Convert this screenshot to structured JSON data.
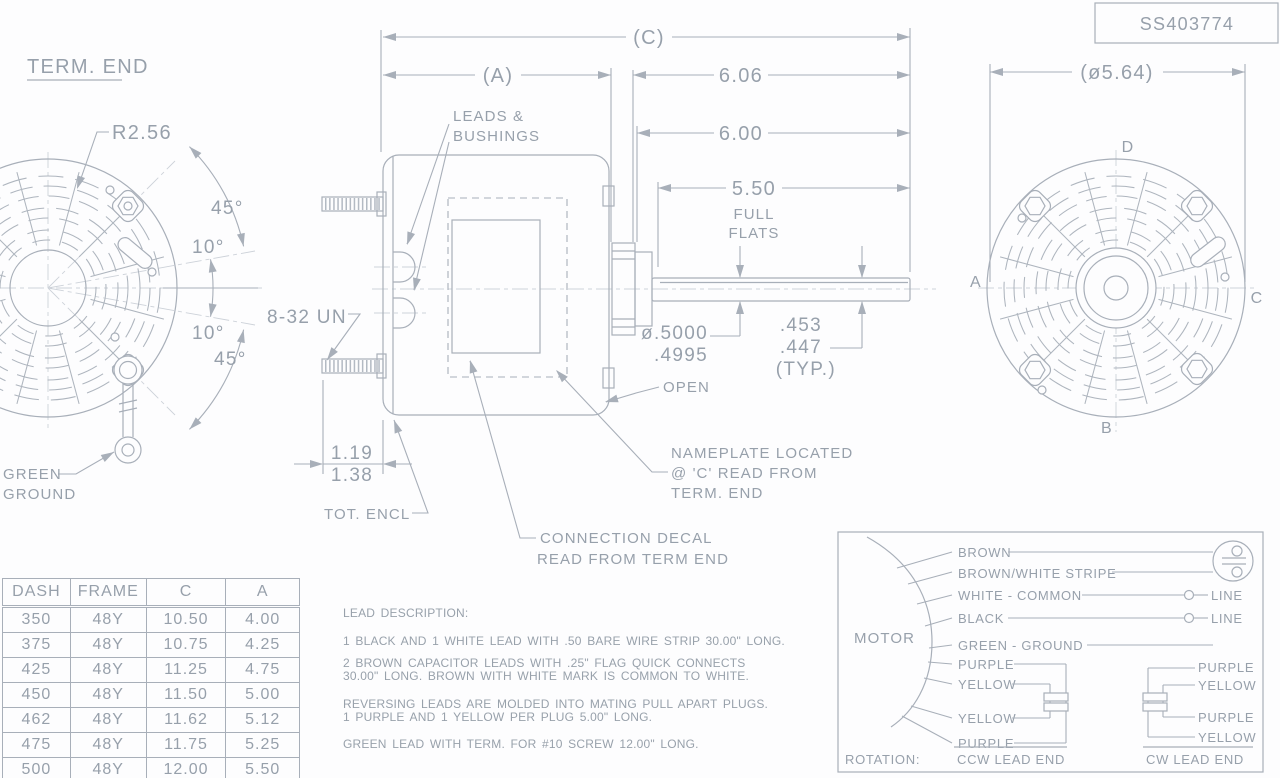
{
  "title_block": {
    "drawing_number": "SS403774"
  },
  "term_end_view": {
    "title": "TERM. END",
    "radius": "R2.56",
    "angle_top_45": "45°",
    "angle_top_10": "10°",
    "angle_bottom_10": "10°",
    "angle_bottom_45": "45°",
    "ground_line1": "GREEN",
    "ground_line2": "GROUND"
  },
  "side_view": {
    "dim_c": "(C)",
    "dim_a": "(A)",
    "dim_6_06": "6.06",
    "dim_6_00": "6.00",
    "dim_5_50": "5.50",
    "full_flats_1": "FULL",
    "full_flats_2": "FLATS",
    "leads_note_1": "LEADS &",
    "leads_note_2": "BUSHINGS",
    "stud_thread": "8-32 UN",
    "stud_dim_1": "1.19",
    "stud_dim_2": "1.38",
    "enclosure_note": "TOT. ENCL",
    "open_note": "OPEN",
    "shaft_dia_1": "ø.5000",
    "shaft_dia_2": ".4995",
    "flat_dim_1": ".453",
    "flat_dim_2": ".447",
    "flat_dim_3": "(TYP.)",
    "nameplate_note_1": "NAMEPLATE LOCATED",
    "nameplate_note_2": "@ 'C' READ FROM",
    "nameplate_note_3": "TERM. END",
    "decal_note_1": "CONNECTION DECAL",
    "decal_note_2": "READ FROM TERM END"
  },
  "shaft_end_view": {
    "dim_dia": "(ø5.64)",
    "marker_a": "A",
    "marker_b": "B",
    "marker_c": "C",
    "marker_d": "D"
  },
  "spec_table": {
    "headers": [
      "DASH",
      "FRAME",
      "C",
      "A"
    ],
    "rows": [
      {
        "dash": "350",
        "frame": "48Y",
        "c": "10.50",
        "a": "4.00"
      },
      {
        "dash": "375",
        "frame": "48Y",
        "c": "10.75",
        "a": "4.25"
      },
      {
        "dash": "425",
        "frame": "48Y",
        "c": "11.25",
        "a": "4.75"
      },
      {
        "dash": "450",
        "frame": "48Y",
        "c": "11.50",
        "a": "5.00"
      },
      {
        "dash": "462",
        "frame": "48Y",
        "c": "11.62",
        "a": "5.12"
      },
      {
        "dash": "475",
        "frame": "48Y",
        "c": "11.75",
        "a": "5.25"
      },
      {
        "dash": "500",
        "frame": "48Y",
        "c": "12.00",
        "a": "5.50"
      }
    ]
  },
  "lead_description": {
    "title": "LEAD DESCRIPTION:",
    "p1_l1": "1 BLACK AND 1 WHITE LEAD WITH .50 BARE WIRE STRIP 30.00\" LONG.",
    "p2_l1": "2 BROWN CAPACITOR LEADS WITH .25\" FLAG QUICK CONNECTS",
    "p2_l2": "30.00\" LONG. BROWN WITH WHITE MARK IS COMMON TO WHITE.",
    "p3_l1": "REVERSING LEADS ARE MOLDED INTO MATING PULL APART PLUGS.",
    "p3_l2": "1 PURPLE AND 1 YELLOW PER PLUG 5.00\" LONG.",
    "p4_l1": "GREEN LEAD WITH TERM. FOR #10 SCREW 12.00\" LONG."
  },
  "wiring_diagram": {
    "motor_label": "MOTOR",
    "lead_brown": "BROWN",
    "lead_brown_white": "BROWN/WHITE STRIPE",
    "lead_white": "WHITE - COMMON",
    "lead_black": "BLACK",
    "lead_green": "GREEN - GROUND",
    "line_top": "LINE",
    "line_bottom": "LINE",
    "ccw_purple_top": "PURPLE",
    "ccw_yellow_top": "YELLOW",
    "ccw_yellow_bottom": "YELLOW",
    "ccw_purple_bottom": "PURPLE",
    "cw_purple_top": "PURPLE",
    "cw_yellow_top": "YELLOW",
    "cw_purple_bottom": "PURPLE",
    "cw_yellow_bottom": "YELLOW",
    "rotation_label": "ROTATION:",
    "rotation_ccw": "CCW LEAD END",
    "rotation_cw": "CW LEAD END"
  },
  "colors": {
    "line": "#a8afb9",
    "text": "#97a0ab",
    "centerline": "#cdd2d9",
    "background": "#fdfdfe"
  }
}
